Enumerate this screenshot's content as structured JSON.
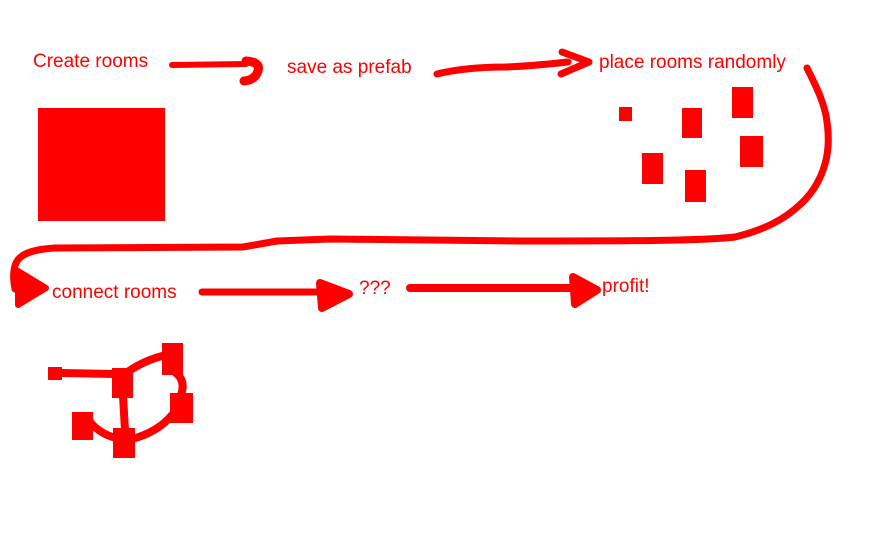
{
  "palette": {
    "ink": "#ff0000",
    "background": "#ffffff"
  },
  "labels": {
    "create_rooms": "Create rooms",
    "save_as_prefab": "save as prefab",
    "place_rooms_randomly": "place rooms randomly",
    "connect_rooms": "connect rooms",
    "unknown": "???",
    "profit": "profit!"
  },
  "sketch": {
    "big_room": {
      "x": 38,
      "y": 108,
      "w": 127,
      "h": 113
    },
    "scattered_rooms": [
      {
        "x": 619,
        "y": 107,
        "w": 13,
        "h": 14
      },
      {
        "x": 682,
        "y": 108,
        "w": 20,
        "h": 30
      },
      {
        "x": 732,
        "y": 87,
        "w": 21,
        "h": 31
      },
      {
        "x": 740,
        "y": 136,
        "w": 23,
        "h": 31
      },
      {
        "x": 642,
        "y": 153,
        "w": 21,
        "h": 31
      },
      {
        "x": 685,
        "y": 170,
        "w": 21,
        "h": 32
      }
    ],
    "graph": {
      "nodes": [
        {
          "x": 48,
          "y": 367,
          "w": 14,
          "h": 13
        },
        {
          "x": 112,
          "y": 368,
          "w": 21,
          "h": 30
        },
        {
          "x": 162,
          "y": 343,
          "w": 21,
          "h": 32
        },
        {
          "x": 170,
          "y": 393,
          "w": 23,
          "h": 30
        },
        {
          "x": 72,
          "y": 412,
          "w": 21,
          "h": 28
        },
        {
          "x": 113,
          "y": 428,
          "w": 22,
          "h": 30
        }
      ],
      "edges": [
        {
          "d": "M62 373 L114 374"
        },
        {
          "d": "M129 371 Q145 360 166 355"
        },
        {
          "d": "M176 373 Q186 381 181 395"
        },
        {
          "d": "M123 396 L125 430"
        },
        {
          "d": "M90 422 Q100 434 116 438"
        },
        {
          "d": "M132 439 Q158 432 172 415"
        }
      ]
    }
  }
}
